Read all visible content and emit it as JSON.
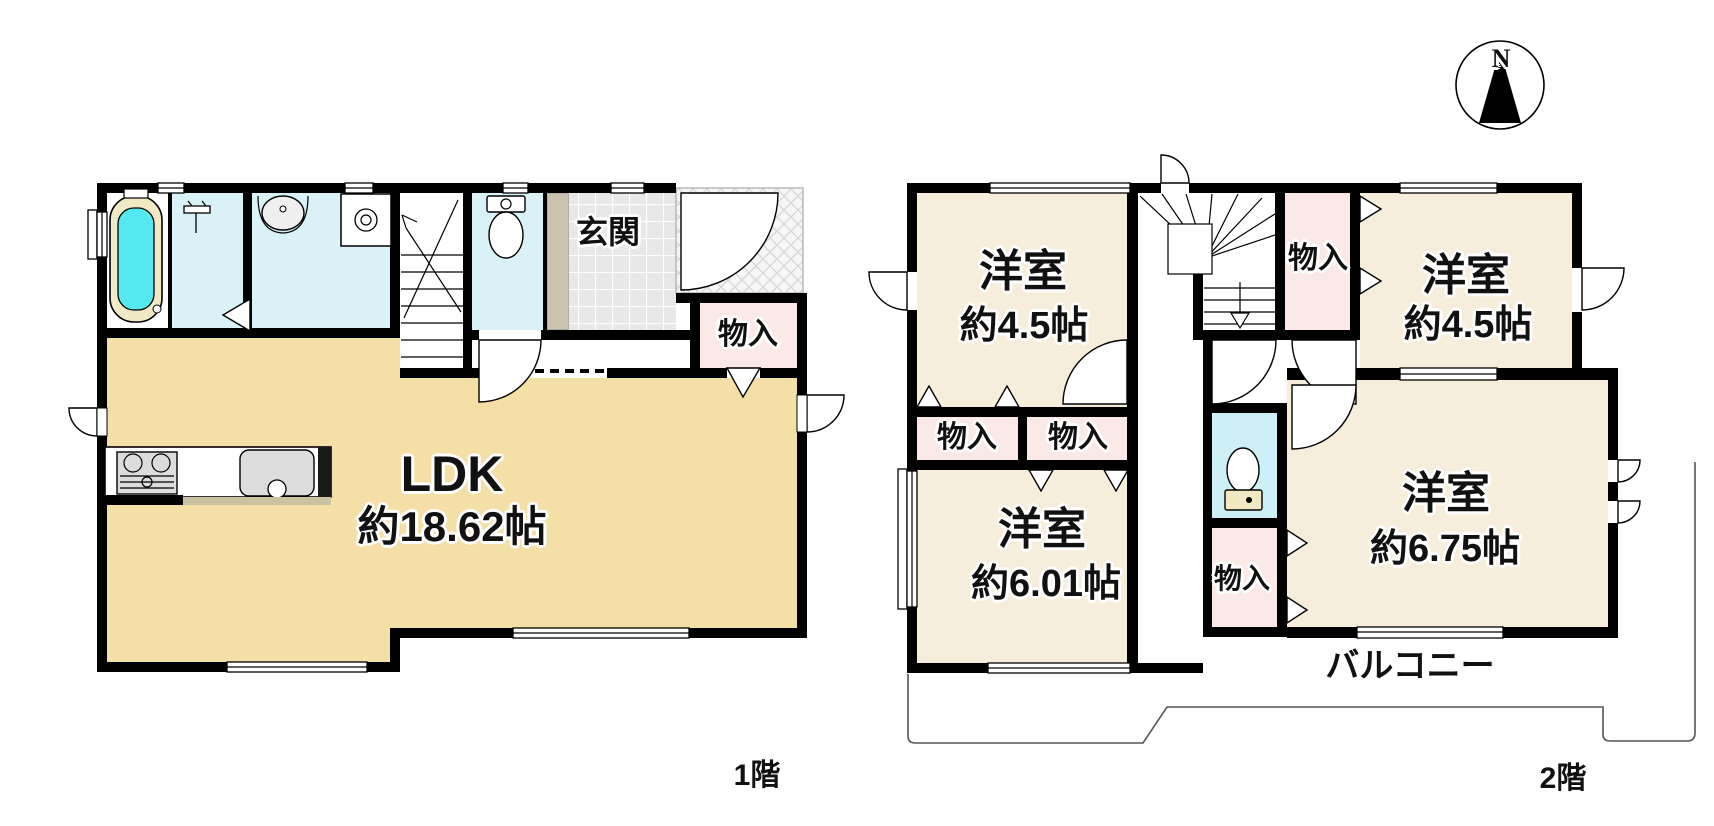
{
  "compass": {
    "north_label": "N"
  },
  "floor1": {
    "floor_label": "1階",
    "ldk_line1": "LDK",
    "ldk_line2": "約18.62帖",
    "genkan_label": "玄関",
    "storage_label": "物入"
  },
  "floor2": {
    "floor_label": "2階",
    "room_nw_line1": "洋室",
    "room_nw_line2": "約4.5帖",
    "room_ne_line1": "洋室",
    "room_ne_line2": "約4.5帖",
    "room_sw_line1": "洋室",
    "room_sw_line2": "約6.01帖",
    "room_se_line1": "洋室",
    "room_se_line2": "約6.75帖",
    "storage_a_label": "物入",
    "storage_b_label": "物入",
    "storage_c_label": "物入",
    "storage_d_label": "物入",
    "balcony_label": "バルコニー"
  },
  "colors": {
    "room_1f_fill": "#F4DFA6",
    "room_2f_fill": "#F6EEDA",
    "storage_fill": "#FBE9E7",
    "wet_room_fill": "#D8F2F7",
    "bathtub_fill": "#54E8F0",
    "wall": "#000000"
  }
}
